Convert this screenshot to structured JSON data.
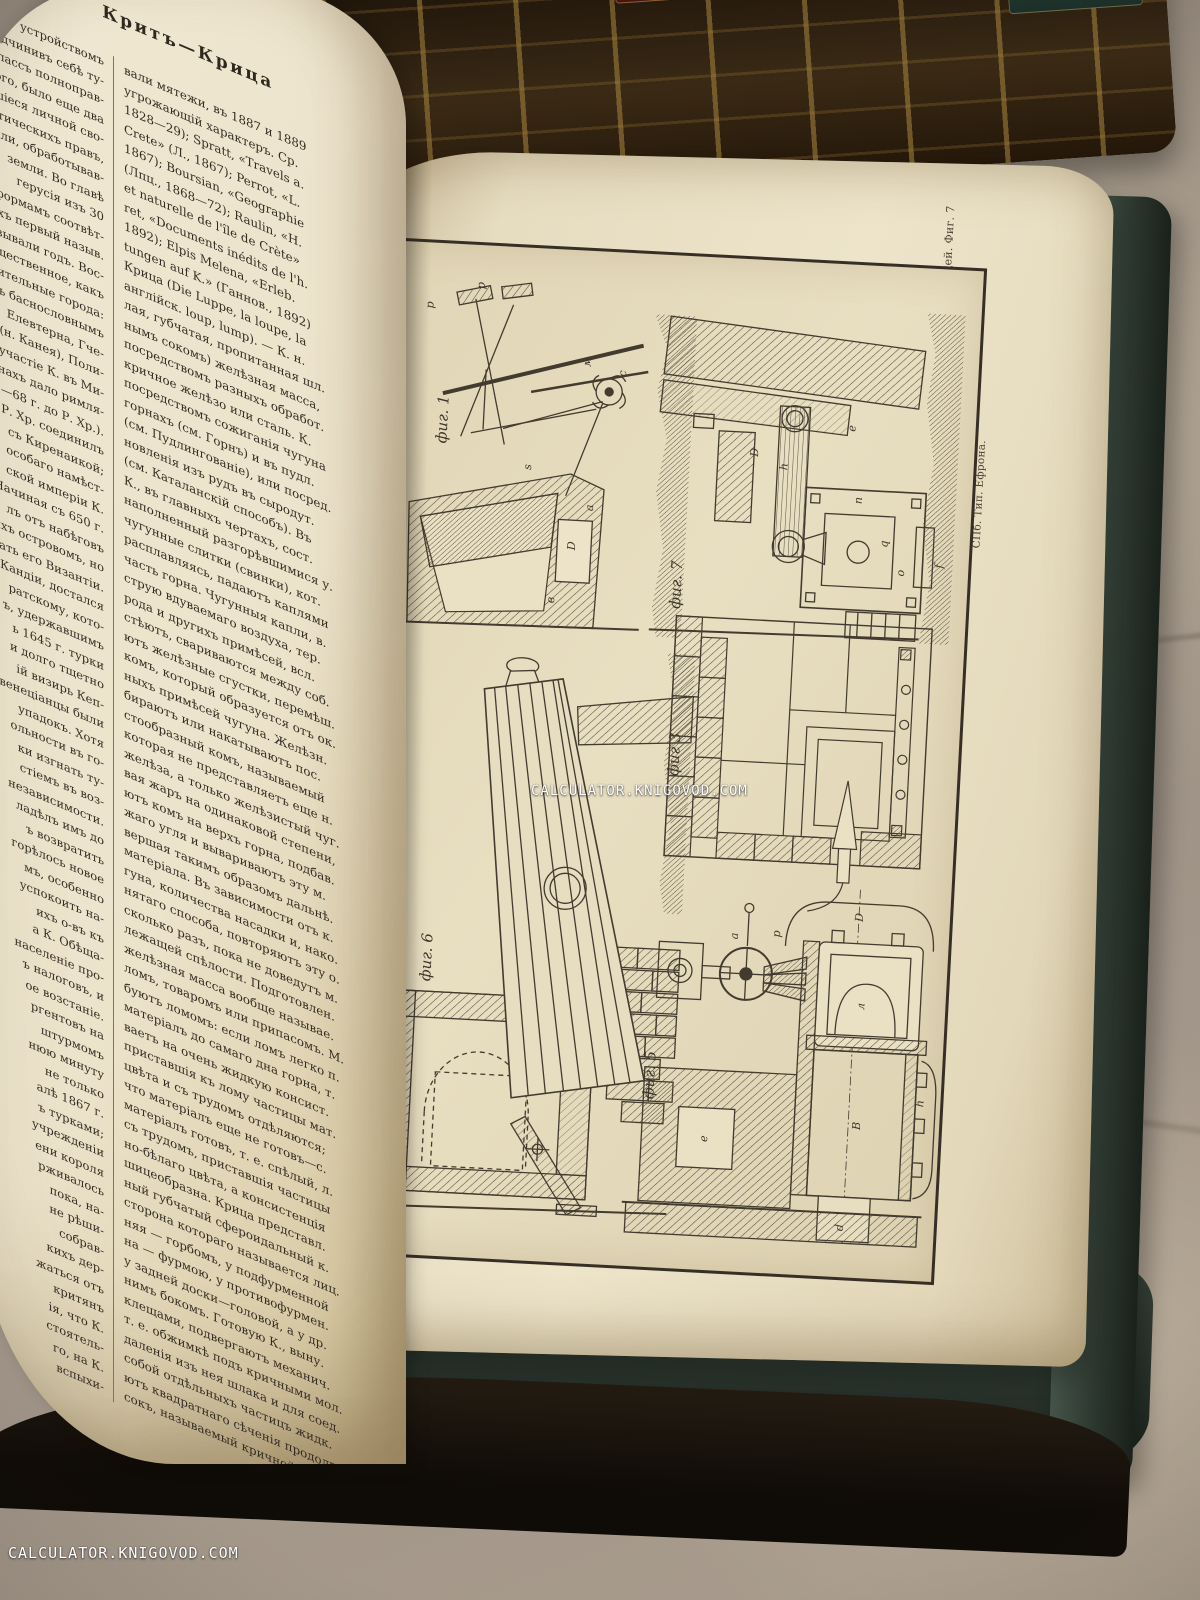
{
  "watermark": {
    "text": "CALCULATOR.KNIGOVOD.COM"
  },
  "left_page": {
    "header": "Критъ—Крица",
    "column_left": {
      "lines": [
        "устройствомъ",
        "Подчинивъ себѣ ту-",
        "ній классъ полноправ-",
        "того, было еще два",
        "вавшіеся личной сво-",
        "политическихъ правъ,",
        "земли, обработывав-",
        "земли. Во главѣ",
        "герусія изъ 30",
        "формамъ соотвѣт-",
        "рыхъ первый назыв.",
        "называли годъ. Вос-",
        "общественное, какъ",
        "ачительные города:",
        "съ баснословнымъ",
        "Елевтерна, Гче-",
        "(н. Канея), Поли-",
        "участіе К. въ Ми-",
        "нахъ дало римля-",
        "7—68 г. до Р. Хр.).",
        "Р. Хр. соединилъ",
        "съ Киренаикой;",
        "особаго намѣст-",
        "ской имперіи К.",
        "Начиная съ 650 г.",
        "лъ отъ набѣговъ",
        "ихъ островомъ, но",
        "ать его Византіи.",
        "Кандіи, достался",
        "ратскому, кото-",
        "ъ, удержавшимъ",
        "ь 1645 г. турки",
        "и долго тщетно",
        "ій визирь Кеп-",
        "венеціанцы были",
        "упадокъ. Хотя",
        "ольности въ го-",
        "ки изгнать ту-",
        "стіемъ въ воз-",
        "независимости.",
        "ладѣлъ имъ до",
        "ъ возвратить",
        "горѣлось новое",
        "мъ, особенно",
        "успокоить на-",
        "ихъ о-въ къ",
        "а К. Обѣща-",
        "населеніе про-",
        "ъ налоговъ, и",
        "ое возстаніе.",
        "ргентовъ на",
        "штурмомъ",
        "нюю минуту",
        "не только",
        "алѣ 1867 г.",
        "ъ турками;",
        "учрежденіи",
        "ени короля",
        "рживалось",
        "пока, на-",
        "не рѣши-",
        "собрав-",
        "кихъ дер-",
        "жаться отъ",
        "критянъ",
        "ія, что К.",
        "стоятель-",
        "го, на К.",
        "вспыхи-"
      ]
    },
    "column_right": {
      "lines": [
        "вали мятежи, въ 1887 и 1889",
        "угрожающій характеръ. Ср.",
        "1828—29); Spratt, «Travels a.",
        "Crete» (Л., 1867); Perrot, «L.",
        "1867); Boursian, «Geographie",
        "(Лпц., 1868—72); Raulin, «H.",
        "et naturelle de l'île de Crète»",
        "ret, «Documents inédits de l'h.",
        "1892); Elpis Melena, «Erleb.",
        "tungen auf K.» (Ганнов., 1892)",
        "Крица (Die Luppe, la loupe, la",
        "англійск. loup, lump). — К. н.",
        "лая, губчатая, пропитанная шл.",
        "нымъ сокомъ) желѣзная масса,",
        "посредствомъ разныхъ обработ.",
        "кричное желѣзо или сталь. К.",
        "посредствомъ сожиганія чугуна",
        "горнахъ (см. Горнъ) и въ пудл.",
        "(см. Пудлингованіе), или посред.",
        "новленія изъ рудъ въ сыродут.",
        "(см. Каталанскій способъ). Въ",
        "К., въ главныхъ чертахъ, сост.",
        "наполненный разгорѣвшимися у.",
        "чугунные слитки (свинки), кот.",
        "расплавляясь, падаютъ каплями",
        "часть горна. Чугунныя капли, в.",
        "струю вдуваемаго воздуха, тер.",
        "рода и другихъ примѣсей, всл.",
        "стѣютъ, свариваются между соб.",
        "ютъ желѣзные сгустки, перемѣш.",
        "комъ, который образуется отъ ок.",
        "ныхъ примѣсей чугуна. Желѣзн.",
        "бираютъ или накатываютъ пос.",
        "стообразный комъ, называемый",
        "которая не представляетъ еще н.",
        "желѣза, а только желѣзистый чуг.",
        "вая жаръ на одинаковой степени,",
        "ютъ комъ на верхъ горна, подбав.",
        "жаго угля и вывариваютъ эту м.",
        "вершая такимъ образомъ дальнѣ.",
        "матеріала. Въ зависимости отъ к.",
        "гуна, количества насадки и, нако.",
        "нятаго способа, повторяютъ эту о.",
        "сколько разъ, пока не доведутъ м.",
        "лежащей спѣлости. Подготовлен.",
        "желѣзная масса вообще называе.",
        "ломъ, товаромъ или припасомъ. М.",
        "буютъ ломомъ: если ломъ легко п.",
        "матеріалъ до самаго дна горна, т.",
        "ваетъ на очень жидкую консист.",
        "приставшія къ лому частицы мат.",
        "цвѣта и съ трудомъ отдѣляются;",
        "что матеріалъ еще не готовъ—с.",
        "матеріалъ готовъ, т. е. спѣлый, л.",
        "съ трудомъ, приставшія частицы",
        "но-бѣлаго цвѣта, а консистенція",
        "шицеобразна. Крица представл.",
        "ный губчатый сфероидальный к.",
        "сторона котораго называется лиц.",
        "няя — горбомъ, у подфурменной",
        "на — фурмою, у противофурмен.",
        "у задней доски—головой, а у др.",
        "нимъ бокомъ. Готовую К., выну.",
        "клещами, подвергаютъ механич.",
        "т. е. обжимкѣ подъ кричными мол.",
        "даленія изъ нея шлака и для соед.",
        "собой отдѣльныхъ частицъ жидк.",
        "ютъ квадратнаго сѣченія продолг.",
        "сокъ, называемый кричной болв."
      ]
    }
  },
  "plate": {
    "title_script": "Кричный передѣлъ.",
    "figures": [
      {
        "label": "фиг. 1",
        "letters": [
          "p",
          "p",
          "м",
          "с",
          "s",
          "D",
          "в",
          "a"
        ]
      },
      {
        "label": "фиг. 7",
        "letters": [
          "D",
          "h",
          "e",
          "n",
          "q",
          "o",
          "f"
        ]
      },
      {
        "label": "фиг 3",
        "letters": []
      },
      {
        "label": "фиг. 6",
        "letters": []
      },
      {
        "label": "фиг. 5",
        "letters": [
          "a",
          "p",
          "D",
          "л",
          "B",
          "e",
          "h",
          "d"
        ]
      }
    ],
    "caption_line1": "Фиг 1. Открытый горнъ.   Фиг. 3. Закрытый старонѣмецкій большекричный горнъ.   Фиг. 5. Контуазскій горнъ.   Фиг. 6. Контуазскій горнъ для тяжеловѣсныхъ вещей.   Фиг. 7",
    "caption_line2": "Шведско-Ланкаширскій горнъ.",
    "imprint": "СПб. Тип. Ефрона."
  },
  "colors": {
    "paper": "#ece3cb",
    "plate_paper": "#e3d8ba",
    "ink": "#3c342a",
    "cover_green": "#2f3b33",
    "fabric": "#9a8e80",
    "gold": "#a8853f",
    "watermark": "#ffffff"
  }
}
